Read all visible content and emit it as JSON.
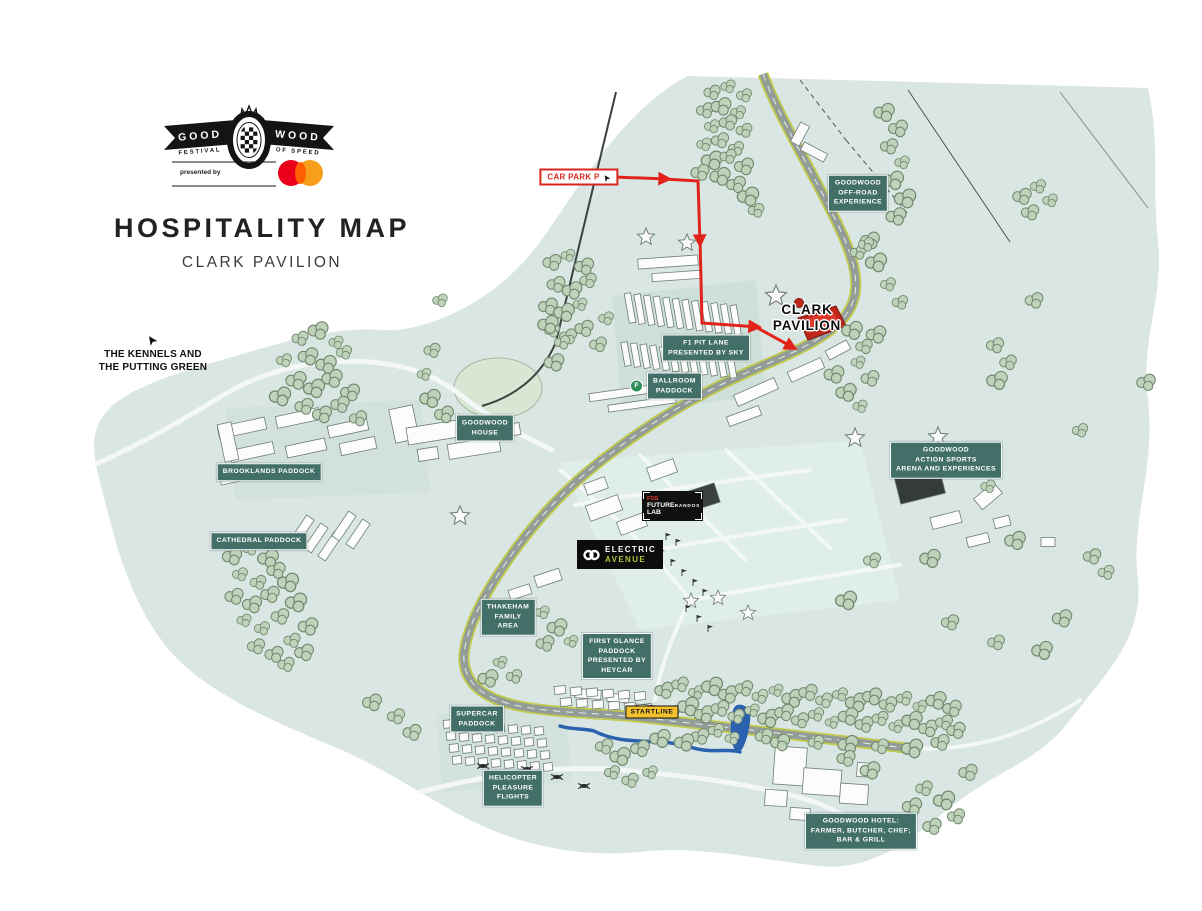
{
  "header": {
    "logo": {
      "word_left": "GOOD",
      "word_right": "WOOD",
      "festival": "FESTIVAL",
      "of_speed": "OF SPEED",
      "presented_by": "presented by"
    },
    "title": "HOSPITALITY MAP",
    "subtitle": "CLARK PAVILION"
  },
  "map": {
    "icons": {
      "cursor_arrow": "➤",
      "facilities_f": "F"
    },
    "labels": {
      "kennels": "THE KENNELS AND\nTHE PUTTING GREEN",
      "car_park": "CAR PARK P",
      "offroad": "GOODWOOD\nOFF-ROAD\nEXPERIENCE",
      "clark_pavilion": "CLARK\nPAVILION",
      "f1_pit_lane": "F1 PIT LANE\nPRESENTED BY SKY",
      "ballroom_paddock": "BALLROOM\nPADDOCK",
      "goodwood_house": "GOODWOOD\nHOUSE",
      "brooklands_paddock": "BROOKLANDS PADDOCK",
      "cathedral_paddock": "CATHEDRAL PADDOCK",
      "fos": "FOS",
      "future_lab": "FUTURE\nLAB",
      "randox": "RANDOX",
      "electric": "ELECTRIC",
      "avenue": "AVENUE",
      "action_sports": "GOODWOOD\nACTION SPORTS\nARENA AND EXPERIENCES",
      "thakeham": "THAKEHAM\nFAMILY\nAREA",
      "first_glance": "FIRST GLANCE\nPADDOCK\nPRESENTED BY\nHEYCAR",
      "supercar": "SUPERCAR\nPADDOCK",
      "startline": "STARTLINE",
      "helicopter": "HELICOPTER\nPLEASURE\nFLIGHTS",
      "hotel": "GOODWOOD HOTEL:\nFARMER, BUTCHER, CHEF;\nBAR & GRILL"
    },
    "colors": {
      "map_base": "#d9e6e3",
      "label_teal": "#426f68",
      "route_red": "#e2231a",
      "startline_yellow": "#f2c12c",
      "river_blue": "#2a62b0",
      "avenue_green": "#a9c73c",
      "mastercard_red": "#eb001b",
      "mastercard_orange": "#f79e1b"
    }
  }
}
